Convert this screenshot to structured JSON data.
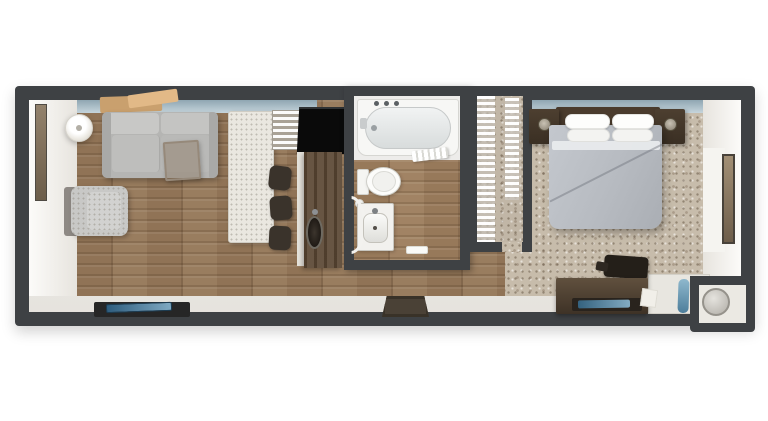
{
  "meta": {
    "type": "3d-floorplan-render",
    "view": "top-down",
    "rooms": [
      "living-room",
      "kitchen",
      "bathroom",
      "closet",
      "bedroom"
    ]
  },
  "palette": {
    "background": "#ffffff",
    "wall": "#3e4144",
    "wood_floor": "#96795b",
    "carpet": "#c7bcab",
    "window_glass": "#aabfc9",
    "sofa_gray": "#b5b5b3",
    "bed_gray": "#b7bbc1",
    "dark_walnut_furniture": "#4a3b2d",
    "fixture_white": "#f4f3f0",
    "accent_blue": "#4d7e9b",
    "appliance_black": "#0a0a0a"
  },
  "scene": {
    "items": [
      {
        "n": "outer-wall",
        "x": 15,
        "y": 86,
        "w": 740,
        "h": 240,
        "z": 1,
        "c": "wall",
        "s": "border-radius:4px;box-shadow:0 6px 14px rgba(0,0,0,.18);"
      },
      {
        "n": "interior-base",
        "x": 29,
        "y": 100,
        "w": 712,
        "h": 212,
        "z": 2,
        "s": "background:linear-gradient(180deg,#efede9,#e6e3de);"
      },
      {
        "n": "living-wood-floor",
        "x": 77,
        "y": 100,
        "w": 433,
        "h": 196,
        "z": 3,
        "c": "wood"
      },
      {
        "n": "bedroom-carpet",
        "x": 505,
        "y": 100,
        "w": 200,
        "h": 196,
        "z": 3,
        "c": "carpet"
      },
      {
        "n": "west-wall-face",
        "x": 29,
        "y": 100,
        "w": 48,
        "h": 196,
        "z": 4,
        "c": "whitewall"
      },
      {
        "n": "east-wall-face",
        "x": 703,
        "y": 100,
        "w": 38,
        "h": 196,
        "z": 4,
        "s": "background:linear-gradient(270deg,#fcfbf9,#e7e4de);"
      },
      {
        "n": "living-window-band",
        "x": 77,
        "y": 100,
        "w": 240,
        "h": 13,
        "z": 4,
        "c": "band"
      },
      {
        "n": "bedroom-window-band",
        "x": 532,
        "y": 100,
        "w": 171,
        "h": 13,
        "z": 4,
        "c": "band"
      },
      {
        "n": "wall-art",
        "x": 100,
        "y": 96,
        "w": 62,
        "h": 16,
        "z": 5,
        "s": "background:#c9a06e;transform:rotate(-2deg);border-radius:2px;"
      },
      {
        "n": "wall-art-2",
        "x": 128,
        "y": 92,
        "w": 50,
        "h": 13,
        "z": 5,
        "s": "background:#e2b987;transform:rotate(-8deg);border-radius:2px;"
      },
      {
        "n": "west-mirror",
        "x": 35,
        "y": 104,
        "w": 12,
        "h": 97,
        "z": 5,
        "s": "background:linear-gradient(180deg,#93826c,#6c5d4a);border:1px solid #4e4a43;"
      },
      {
        "n": "floor-lamp",
        "x": 65,
        "y": 114,
        "w": 28,
        "h": 28,
        "z": 5,
        "s": "border-radius:50%;background:radial-gradient(circle at 45% 40%,#ffffff 0 40%,#e7e4dc 70%,#d8d5cc 100%);box-shadow:0 2px 6px rgba(0,0,0,.25);border:1px solid #d5d2ca;"
      },
      {
        "n": "floor-lamp-finial",
        "x": 76,
        "y": 125,
        "w": 6,
        "h": 6,
        "z": 6,
        "s": "border-radius:50%;background:#b3afa6;"
      },
      {
        "n": "sofa-base",
        "x": 102,
        "y": 112,
        "w": 116,
        "h": 66,
        "z": 5,
        "s": "background:#b5b5b3;border-radius:6px;box-shadow:2px 3px 6px rgba(0,0,0,.28);"
      },
      {
        "n": "sofa-back-cushion-left",
        "x": 107,
        "y": 113,
        "w": 52,
        "h": 21,
        "z": 6,
        "s": "background:#c8c8c6;border-radius:4px;"
      },
      {
        "n": "sofa-back-cushion-right",
        "x": 161,
        "y": 113,
        "w": 52,
        "h": 21,
        "z": 6,
        "s": "background:#c4c4c2;border-radius:4px;"
      },
      {
        "n": "sofa-seat-cushion-left",
        "x": 112,
        "y": 135,
        "w": 48,
        "h": 37,
        "z": 6,
        "s": "background:#bebebc;border-radius:4px;border-right:1px solid rgba(0,0,0,.10);"
      },
      {
        "n": "sofa-seat-cushion-right",
        "x": 161,
        "y": 135,
        "w": 49,
        "h": 37,
        "z": 6,
        "s": "background:#b9b9b7;border-radius:4px;"
      },
      {
        "n": "sofa-arm-left",
        "x": 102,
        "y": 112,
        "w": 9,
        "h": 66,
        "z": 6,
        "s": "background:#a9a9a7;border-radius:5px 2px 2px 5px;"
      },
      {
        "n": "sofa-arm-right",
        "x": 209,
        "y": 112,
        "w": 9,
        "h": 66,
        "z": 6,
        "s": "background:#a9a9a7;border-radius:2px 5px 5px 2px;"
      },
      {
        "n": "side-table",
        "x": 164,
        "y": 141,
        "w": 36,
        "h": 39,
        "z": 7,
        "s": "background:rgba(140,120,98,.45);border:2px solid #96897a;border-radius:2px;transform:rotate(-4deg);box-shadow:1px 2px 4px rgba(0,0,0,.25);"
      },
      {
        "n": "armchair-frame",
        "x": 64,
        "y": 187,
        "w": 15,
        "h": 49,
        "z": 5,
        "s": "background:#8e8984;border-radius:3px;"
      },
      {
        "n": "armchair",
        "x": 71,
        "y": 186,
        "w": 57,
        "h": 50,
        "z": 6,
        "c": "speckle",
        "s": "background-color:#c8c8c6;border-radius:8px;box-shadow:2px 2px 5px rgba(0,0,0,.25);"
      },
      {
        "n": "armchair-cushion",
        "x": 87,
        "y": 192,
        "w": 34,
        "h": 38,
        "z": 7,
        "c": "speckle",
        "s": "background-color:#d2d2d0;border-radius:6px;"
      },
      {
        "n": "kitchen-island",
        "x": 228,
        "y": 111,
        "w": 46,
        "h": 132,
        "z": 5,
        "c": "speckle",
        "s": "background-color:#eae7e0;border:1px solid #cfccc3;border-radius:3px;box-shadow:2px 2px 5px rgba(0,0,0,.22);"
      },
      {
        "n": "island-shelf",
        "x": 272,
        "y": 110,
        "w": 30,
        "h": 40,
        "z": 5,
        "c": "slats",
        "s": "background-color:#b6b1a8;border:1px solid #a19c92;"
      },
      {
        "n": "bar-stool-1",
        "x": 269,
        "y": 166,
        "w": 22,
        "h": 24,
        "z": 6,
        "s": "background:#3a332b;border-radius:6px;transform:rotate(6deg);box-shadow:1px 1px 3px rgba(0,0,0,.4);"
      },
      {
        "n": "bar-stool-2",
        "x": 270,
        "y": 196,
        "w": 22,
        "h": 24,
        "z": 6,
        "s": "background:#3a332b;border-radius:6px;transform:rotate(-4deg);box-shadow:1px 1px 3px rgba(0,0,0,.4);"
      },
      {
        "n": "bar-stool-3",
        "x": 269,
        "y": 226,
        "w": 22,
        "h": 24,
        "z": 6,
        "s": "background:#3a332b;border-radius:6px;transform:rotate(3deg);box-shadow:1px 1px 3px rgba(0,0,0,.4);"
      },
      {
        "n": "tv-black-counter",
        "x": 298,
        "y": 107,
        "w": 48,
        "h": 47,
        "z": 5,
        "s": "background:#0a0a0a;border-top:2px solid #2f3234;transform:skewX(-3deg);"
      },
      {
        "n": "kitchen-counter-front",
        "x": 297,
        "y": 152,
        "w": 8,
        "h": 114,
        "z": 5,
        "s": "background:#e5e2db;"
      },
      {
        "n": "kitchen-counter",
        "x": 304,
        "y": 152,
        "w": 38,
        "h": 116,
        "z": 5,
        "s": "background-color:#5f4c39;background-image:repeating-linear-gradient(90deg,rgba(30,18,8,.25) 0 3px,rgba(255,255,255,.05) 3px 10px);box-shadow:-2px 2px 4px rgba(0,0,0,.25);"
      },
      {
        "n": "kitchen-sink",
        "x": 306,
        "y": 216,
        "w": 17,
        "h": 33,
        "z": 6,
        "s": "border-radius:50%;background:radial-gradient(#3c352d,#130f0b);border:2px solid #6e6a61;"
      },
      {
        "n": "kitchen-faucet",
        "x": 312,
        "y": 209,
        "w": 6,
        "h": 6,
        "z": 7,
        "s": "border-radius:50%;background:#8d9093;"
      },
      {
        "n": "bathroom-block",
        "x": 344,
        "y": 86,
        "w": 126,
        "h": 184,
        "z": 5,
        "c": "wall",
        "s": "box-shadow:2px 2px 6px rgba(0,0,0,.3);"
      },
      {
        "n": "bathroom-tile-floor",
        "x": 354,
        "y": 96,
        "w": 106,
        "h": 66,
        "z": 6,
        "s": "background:#edecea;"
      },
      {
        "n": "bathroom-wood-floor",
        "x": 354,
        "y": 160,
        "w": 106,
        "h": 100,
        "z": 6,
        "c": "wood",
        "s": "filter:brightness(1.05);"
      },
      {
        "n": "bathtub",
        "x": 357,
        "y": 99,
        "w": 102,
        "h": 57,
        "z": 7,
        "s": "background:#f7f7f5;border:1px solid #d6d6d2;border-radius:3px 3px 10px 10px;"
      },
      {
        "n": "bathtub-basin",
        "x": 365,
        "y": 107,
        "w": 86,
        "h": 42,
        "z": 8,
        "s": "border-radius:21px;background:linear-gradient(180deg,#f1f3f3,#d8dcdc);border:1px solid #c6c9c9;"
      },
      {
        "n": "tub-faucet-1",
        "x": 374,
        "y": 101,
        "w": 5,
        "h": 5,
        "z": 9,
        "s": "border-radius:50%;background:#5b6064;"
      },
      {
        "n": "tub-faucet-2",
        "x": 384,
        "y": 101,
        "w": 5,
        "h": 5,
        "z": 9,
        "s": "border-radius:50%;background:#5b6064;"
      },
      {
        "n": "tub-faucet-3",
        "x": 394,
        "y": 101,
        "w": 5,
        "h": 5,
        "z": 9,
        "s": "border-radius:50%;background:#5b6064;"
      },
      {
        "n": "tub-spout",
        "x": 360,
        "y": 118,
        "w": 7,
        "h": 11,
        "z": 9,
        "s": "background:#c9cccd;border-radius:2px;"
      },
      {
        "n": "tub-drain",
        "x": 371,
        "y": 125,
        "w": 6,
        "h": 6,
        "z": 9,
        "s": "border-radius:50%;background:#9aa0a3;"
      },
      {
        "n": "rolled-towels",
        "x": 412,
        "y": 149,
        "w": 36,
        "h": 11,
        "z": 8,
        "c": "towel",
        "s": "transform:rotate(-7deg);border-radius:2px;box-shadow:1px 1px 2px rgba(0,0,0,.25);"
      },
      {
        "n": "toilet-tank",
        "x": 357,
        "y": 169,
        "w": 12,
        "h": 26,
        "z": 8,
        "s": "background:#f5f5f2;border:1px solid #d2d2cd;border-radius:2px;"
      },
      {
        "n": "toilet-bowl",
        "x": 366,
        "y": 167,
        "w": 35,
        "h": 29,
        "z": 8,
        "s": "border-radius:50%;background:#fcfcfa;border:1px solid #cfcfc9;box-shadow:1px 1px 3px rgba(0,0,0,.18);"
      },
      {
        "n": "toilet-seat",
        "x": 372,
        "y": 171,
        "w": 24,
        "h": 21,
        "z": 9,
        "s": "border-radius:50%;background:#f1f1ee;border:1px solid #dadad5;"
      },
      {
        "n": "toilet-paper",
        "x": 355,
        "y": 199,
        "w": 9,
        "h": 9,
        "z": 8,
        "s": "background:#f2f2ef;border-radius:50%;border:1px solid #d8d8d3;"
      },
      {
        "n": "bathroom-door-arc",
        "x": 336,
        "y": 196,
        "w": 30,
        "h": 58,
        "z": 9,
        "s": "border:3px solid #f3f2ef;border-radius:50%;clip-path:inset(0 0 0 52%);"
      },
      {
        "n": "vanity",
        "x": 357,
        "y": 203,
        "w": 37,
        "h": 48,
        "z": 8,
        "s": "background:#f2f1ee;border:1px solid #c8c6bf;border-radius:2px;box-shadow:1px 1px 3px rgba(0,0,0,.2);"
      },
      {
        "n": "vanity-sink",
        "x": 363,
        "y": 213,
        "w": 25,
        "h": 30,
        "z": 9,
        "s": "border-radius:8px;background:linear-gradient(180deg,#fbfbf9,#dededa);border:1px solid #c4c2bb;"
      },
      {
        "n": "vanity-faucet",
        "x": 372,
        "y": 208,
        "w": 6,
        "h": 6,
        "z": 10,
        "s": "border-radius:50%;background:#7d8184;"
      },
      {
        "n": "vanity-drain",
        "x": 373,
        "y": 226,
        "w": 4,
        "h": 4,
        "z": 10,
        "s": "border-radius:50%;background:#544f49;"
      },
      {
        "n": "bath-mat",
        "x": 406,
        "y": 246,
        "w": 22,
        "h": 8,
        "z": 8,
        "s": "background:#fafaf7;border:1px solid #dcdcd6;border-radius:2px;"
      },
      {
        "n": "closet-block",
        "x": 468,
        "y": 86,
        "w": 64,
        "h": 166,
        "z": 5,
        "c": "wall"
      },
      {
        "n": "closet-floor",
        "x": 477,
        "y": 96,
        "w": 46,
        "h": 146,
        "z": 6,
        "c": "carpet",
        "s": "filter:brightness(.97);"
      },
      {
        "n": "closet-wire-shelf-left",
        "x": 477,
        "y": 96,
        "w": 18,
        "h": 146,
        "z": 7,
        "c": "slats",
        "s": "background-color:rgba(255,255,255,.55);"
      },
      {
        "n": "closet-wire-shelf-right",
        "x": 505,
        "y": 98,
        "w": 14,
        "h": 102,
        "z": 7,
        "c": "slats",
        "s": "background-color:rgba(255,255,255,.65);"
      },
      {
        "n": "closet-door-opening",
        "x": 502,
        "y": 242,
        "w": 20,
        "h": 10,
        "z": 6,
        "c": "carpet"
      },
      {
        "n": "headboard",
        "x": 556,
        "y": 107,
        "w": 104,
        "h": 19,
        "z": 5,
        "s": "background:#4a3b2d;border-radius:2px;box-shadow:0 2px 4px rgba(0,0,0,.35);"
      },
      {
        "n": "nightstand-left",
        "x": 529,
        "y": 109,
        "w": 30,
        "h": 35,
        "z": 5,
        "s": "background:linear-gradient(180deg,#4d3f30,#3a2f23);border-radius:2px;box-shadow:2px 2px 4px rgba(0,0,0,.35);"
      },
      {
        "n": "nightstand-right",
        "x": 655,
        "y": 109,
        "w": 30,
        "h": 35,
        "z": 5,
        "s": "background:linear-gradient(180deg,#4d3f30,#3a2f23);border-radius:2px;box-shadow:2px 2px 4px rgba(0,0,0,.35);"
      },
      {
        "n": "table-lamp-left",
        "x": 538,
        "y": 118,
        "w": 13,
        "h": 13,
        "z": 6,
        "s": "border-radius:50%;background:radial-gradient(circle at 45% 40%,#c9c2b4,#857d6e);border:1px solid #57503f;"
      },
      {
        "n": "table-lamp-right",
        "x": 664,
        "y": 118,
        "w": 13,
        "h": 13,
        "z": 6,
        "s": "border-radius:50%;background:radial-gradient(circle at 45% 40%,#c9c2b4,#857d6e);border:1px solid #57503f;"
      },
      {
        "n": "bed-duvet",
        "x": 549,
        "y": 125,
        "w": 113,
        "h": 104,
        "z": 6,
        "s": "background:linear-gradient(115deg,#c4c8ce,#b7bbc1 55%,#aaaeb4);border-radius:3px 3px 12px 10px;box-shadow:3px 4px 8px rgba(0,0,0,.28);"
      },
      {
        "n": "sheet-fold",
        "x": 552,
        "y": 141,
        "w": 108,
        "h": 9,
        "z": 7,
        "s": "background:#e9ecee;border-radius:2px;opacity:.92;"
      },
      {
        "n": "pillow-1",
        "x": 565,
        "y": 114,
        "w": 45,
        "h": 15,
        "z": 7,
        "s": "background:#fdfdfc;border-radius:7px;border:1px solid #e4e4e1;box-shadow:0 1px 2px rgba(0,0,0,.2);"
      },
      {
        "n": "pillow-2",
        "x": 612,
        "y": 114,
        "w": 42,
        "h": 15,
        "z": 7,
        "s": "background:#fdfdfc;border-radius:7px;border:1px solid #e4e4e1;box-shadow:0 1px 2px rgba(0,0,0,.2);"
      },
      {
        "n": "pillow-3",
        "x": 567,
        "y": 129,
        "w": 43,
        "h": 13,
        "z": 8,
        "s": "background:#f3f3f1;border-radius:7px;border:1px solid #e0e0dd;"
      },
      {
        "n": "pillow-4",
        "x": 612,
        "y": 129,
        "w": 41,
        "h": 13,
        "z": 8,
        "s": "background:#f3f3f1;border-radius:7px;border:1px solid #e0e0dd;"
      },
      {
        "n": "duvet-crease",
        "x": 543,
        "y": 172,
        "w": 126,
        "h": 2,
        "z": 7,
        "s": "background:rgba(110,116,124,.45);transform:rotate(-27deg);border-radius:2px;"
      },
      {
        "n": "desk-chair",
        "x": 604,
        "y": 256,
        "w": 44,
        "h": 22,
        "z": 6,
        "s": "background:#241f19;border-radius:4px;transform:rotate(4deg);box-shadow:1px 2px 4px rgba(0,0,0,.35);"
      },
      {
        "n": "desk-chair-arm",
        "x": 596,
        "y": 262,
        "w": 12,
        "h": 9,
        "z": 6,
        "s": "background:#2e2822;border-radius:2px;transform:rotate(10deg);"
      },
      {
        "n": "console-dresser",
        "x": 556,
        "y": 278,
        "w": 92,
        "h": 36,
        "z": 6,
        "s": "background:linear-gradient(180deg,#60503e,#3e3226);border-radius:2px;box-shadow:0 2px 5px rgba(0,0,0,.35);"
      },
      {
        "n": "console-tray",
        "x": 572,
        "y": 298,
        "w": 70,
        "h": 13,
        "z": 7,
        "s": "background:#29231d;border-radius:2px;"
      },
      {
        "n": "tray-blue-item",
        "x": 578,
        "y": 300,
        "w": 52,
        "h": 8,
        "z": 8,
        "s": "background:linear-gradient(90deg,#34627f,#83abc2);border-radius:2px;transform:rotate(-1deg);"
      },
      {
        "n": "console-paper",
        "x": 641,
        "y": 289,
        "w": 16,
        "h": 18,
        "z": 7,
        "s": "background:#f1efe9;border:1px solid #dddbd3;transform:rotate(8deg);"
      },
      {
        "n": "side-counter",
        "x": 648,
        "y": 274,
        "w": 62,
        "h": 40,
        "z": 5,
        "s": "background:#e8e6e0;border:1px solid #d3d0c8;"
      },
      {
        "n": "ironing-board",
        "x": 678,
        "y": 279,
        "w": 11,
        "h": 34,
        "z": 6,
        "s": "background:linear-gradient(180deg,#8fb8cd,#4d7e9b);border-radius:5px;transform:rotate(2deg);"
      },
      {
        "n": "east-wall-bright",
        "x": 703,
        "y": 148,
        "w": 22,
        "h": 104,
        "z": 5,
        "s": "background:#f5f4f0;"
      },
      {
        "n": "east-mirror",
        "x": 722,
        "y": 154,
        "w": 13,
        "h": 90,
        "z": 5,
        "s": "background:linear-gradient(180deg,#a28f75,#6d5d4a);border:2px solid #48423a;"
      },
      {
        "n": "alcove-outer",
        "x": 690,
        "y": 276,
        "w": 65,
        "h": 56,
        "z": 7,
        "c": "wall",
        "s": "border-radius:0 0 4px 4px;"
      },
      {
        "n": "alcove-inner",
        "x": 699,
        "y": 285,
        "w": 47,
        "h": 38,
        "z": 8,
        "s": "background:#ebe9e3;"
      },
      {
        "n": "alcove-round-fixture",
        "x": 702,
        "y": 288,
        "w": 28,
        "h": 28,
        "z": 9,
        "s": "border-radius:50%;background:radial-gradient(circle at 40% 35%,#e5e3de,#b0ada6);border:2px solid #95928b;"
      },
      {
        "n": "bench-mat",
        "x": 94,
        "y": 302,
        "w": 96,
        "h": 15,
        "z": 4,
        "s": "background:#262626;border-radius:2px;"
      },
      {
        "n": "bench-tray-blue",
        "x": 106,
        "y": 303,
        "w": 66,
        "h": 9,
        "z": 5,
        "s": "background:linear-gradient(90deg,#2e5d7e,#7fa9c2);border-radius:2px;transform:rotate(-2deg);border:1px solid #1c3c52;"
      },
      {
        "n": "entry-doormat",
        "x": 382,
        "y": 296,
        "w": 47,
        "h": 21,
        "z": 4,
        "s": "background:#4a4136;border:3px solid #393228;clip-path:polygon(10% 0,90% 0,100% 100%,0 100%);"
      }
    ]
  }
}
